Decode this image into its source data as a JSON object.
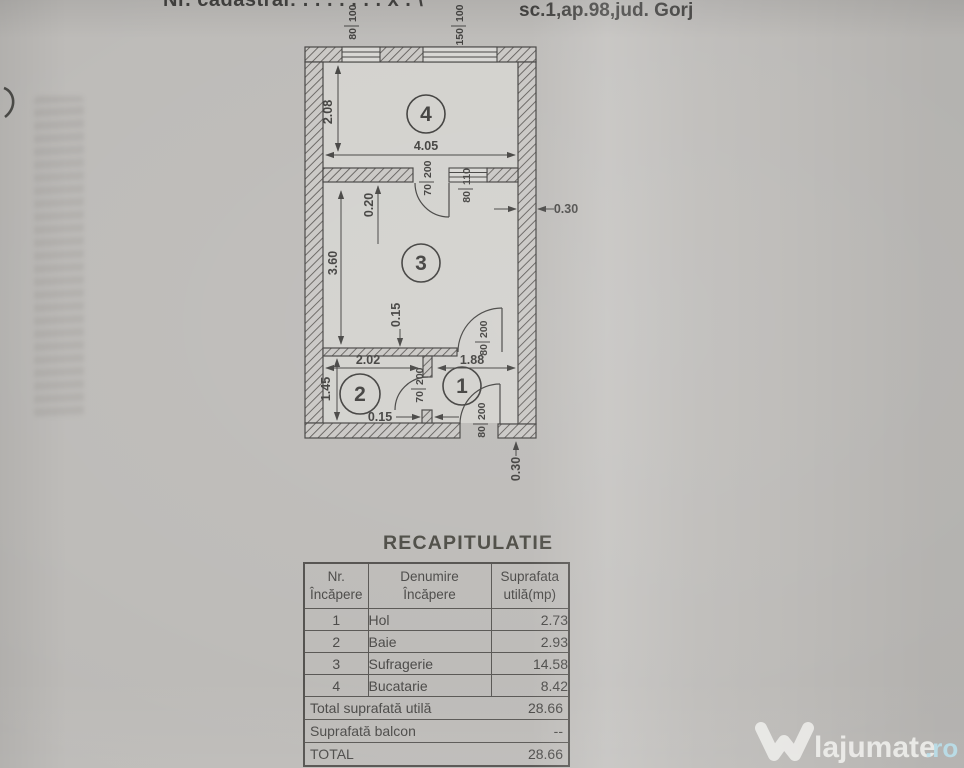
{
  "colors": {
    "paper": "#bbb9b6",
    "ink": "#3f3e3c",
    "watermark_text": "#f4f4f1",
    "watermark_tld": "#bae0ec"
  },
  "header": {
    "cadastral_line": "Nr. cadastral: . . . . . . . x . \\",
    "address_line": "sc.1,ap.98,jud. Gorj"
  },
  "plan": {
    "rooms": {
      "r1": "1",
      "r2": "2",
      "r3": "3",
      "r4": "4"
    },
    "dims": {
      "room4_height": "2.08",
      "room4_width": "4.05",
      "door_offset": "0.20",
      "room3_height": "3.60",
      "interior_wall_thickness": "0.15",
      "right_wall_thickness": "0.30",
      "room2_width": "2.02",
      "hall_width": "1.88",
      "room2_height": "1.45",
      "partition_thickness": "0.15",
      "bottom_wall_thickness": "0.30"
    },
    "openings": {
      "kitchen_window_small": "80/100",
      "kitchen_window_large": "150/100",
      "kitchen_door": "70/200",
      "interior_window": "80/110",
      "living_hall_door": "80/200",
      "bath_door": "70/200",
      "entrance_door": "80/200"
    }
  },
  "table": {
    "title": "RECAPITULATIE",
    "headers": [
      {
        "line1": "Nr.",
        "line2": "Încăpere"
      },
      {
        "line1": "Denumire",
        "line2": "Încăpere"
      },
      {
        "line1": "Suprafata",
        "line2": "utilă(mp)"
      }
    ],
    "rows": [
      {
        "nr": "1",
        "name": "Hol",
        "area": "2.73"
      },
      {
        "nr": "2",
        "name": "Baie",
        "area": "2.93"
      },
      {
        "nr": "3",
        "name": "Sufragerie",
        "area": "14.58"
      },
      {
        "nr": "4",
        "name": "Bucatarie",
        "area": "8.42"
      }
    ],
    "summary": [
      {
        "label": "Total suprafată utilă",
        "value": "28.66"
      },
      {
        "label": "Suprafată balcon",
        "value": "--"
      },
      {
        "label": "TOTAL",
        "value": "28.66"
      }
    ]
  },
  "watermark": {
    "brand": "lajumate",
    "tld": ".ro"
  }
}
